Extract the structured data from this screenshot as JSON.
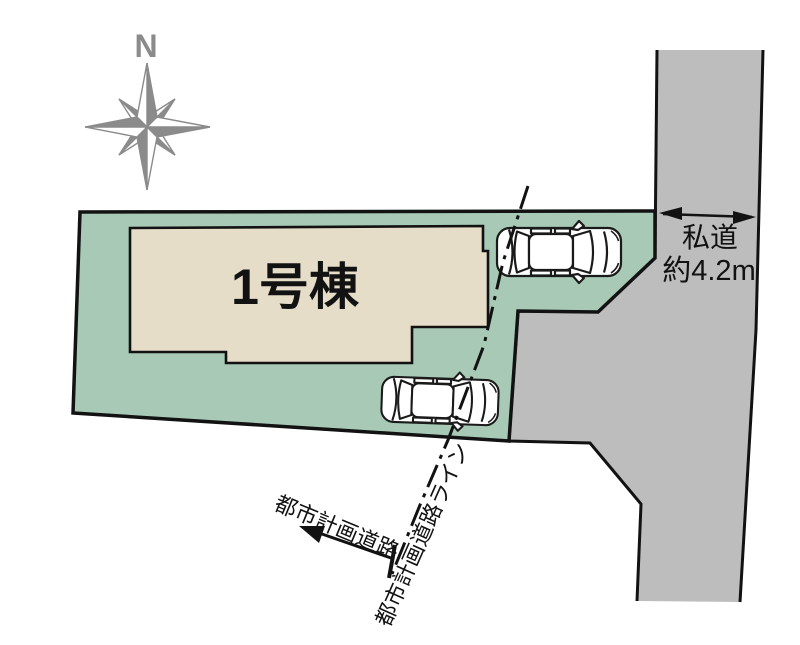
{
  "compass": {
    "north_label": "N"
  },
  "plot": {
    "building_label": "1号棟"
  },
  "private_road": {
    "label_line1": "私道",
    "label_line2": "約4.2m"
  },
  "city_planning": {
    "road_label": "都市計画道路",
    "line_label": "都市計画道路ライン"
  },
  "colors": {
    "plot_green": "#a7c9b5",
    "building_beige": "#e6ddc9",
    "road_gray": "#bdbdbd",
    "outline_black": "#121212",
    "compass_gray": "#8b8b8b",
    "car_white": "#ffffff"
  }
}
